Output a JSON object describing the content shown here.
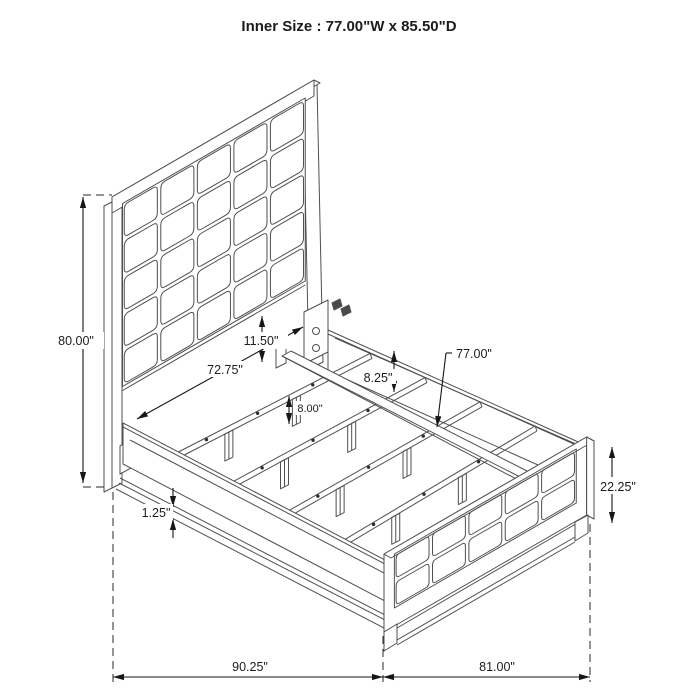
{
  "title": "Inner Size : 77.00\"W x 85.50\"D",
  "dimensions": {
    "headboard_height": "80.00\"",
    "inner_headboard_width": "72.75\"",
    "panel_to_rail_gap": "11.50\"",
    "slat_leg_height": "8.00\"",
    "side_rail_height": "8.25\"",
    "slat_length": "77.00\"",
    "footboard_height": "22.25\"",
    "rail_bottom_lip": "1.25\"",
    "overall_depth": "90.25\"",
    "overall_width": "81.00\""
  }
}
